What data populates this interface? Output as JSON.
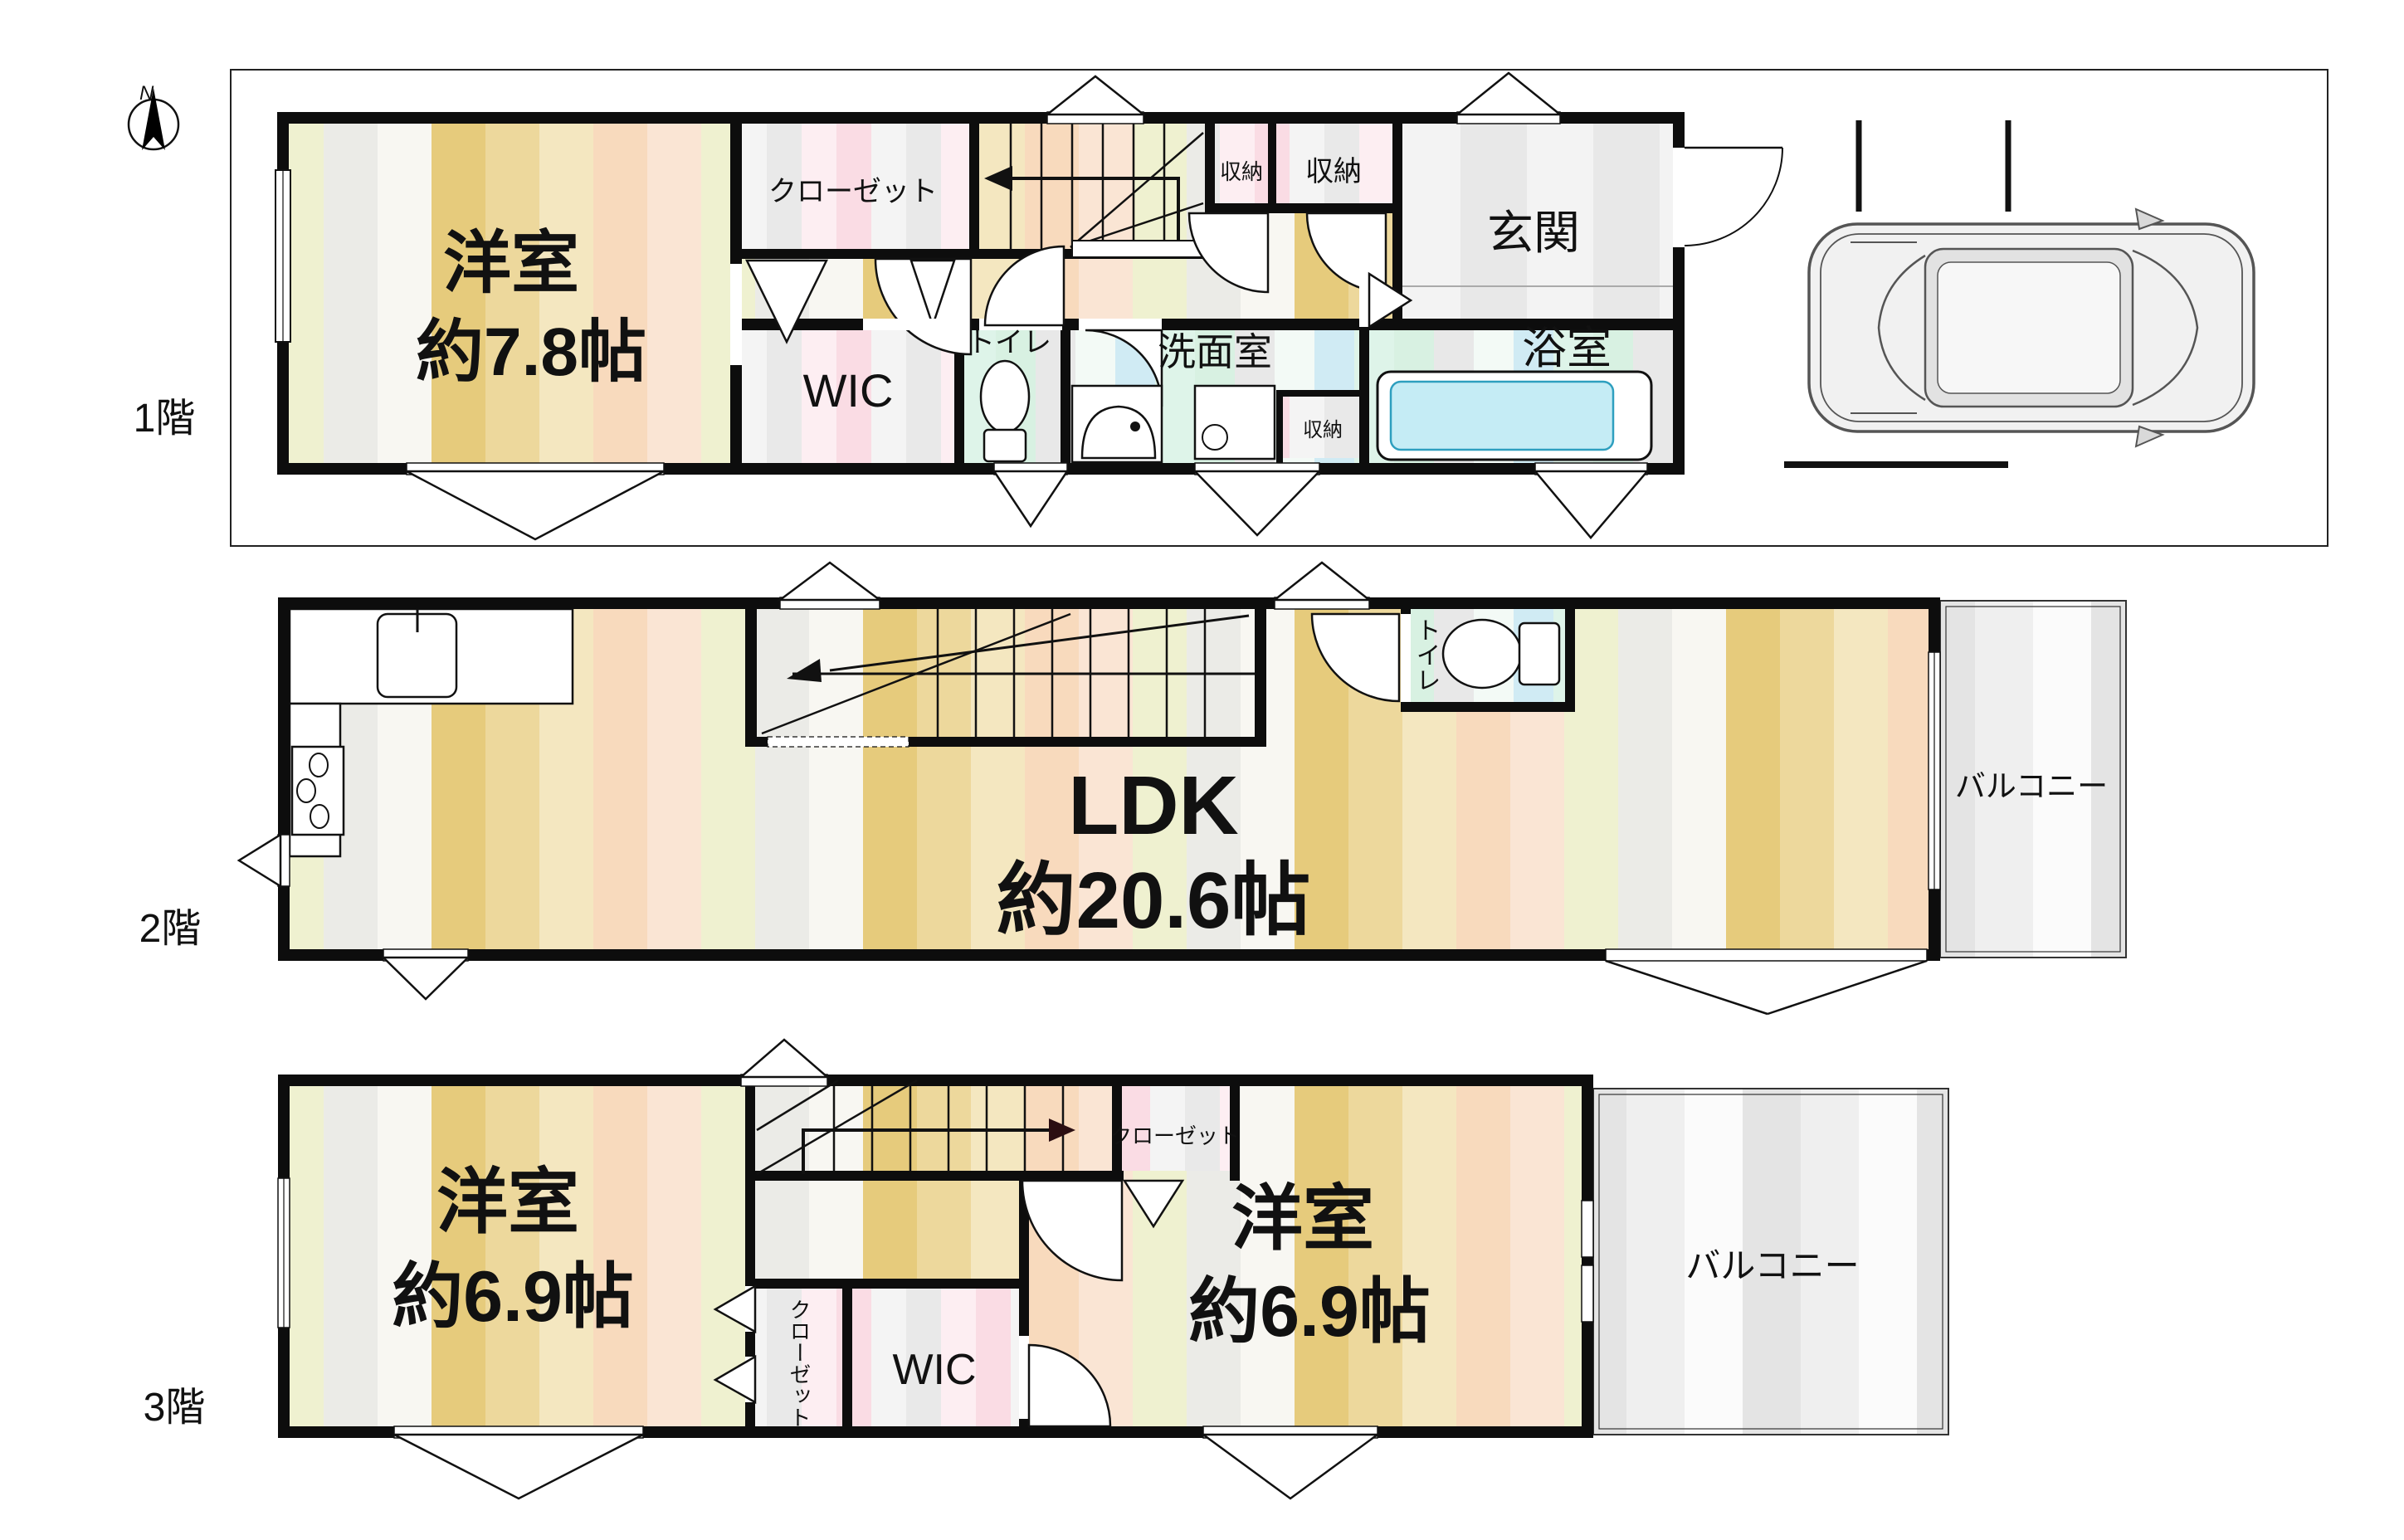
{
  "compass": {
    "north": "N"
  },
  "colors": {
    "wall": "#0d0d0d",
    "floor_gold": "#e6cb7c",
    "floor_tan": "#edd89c",
    "floor_cream": "#f4e7c0",
    "floor_peach": "#f8dabd",
    "floor_blush": "#fae5d4",
    "floor_green": "#eff1d0",
    "floor_gray": "#ebebe7",
    "wet_mint": "#d8f1e2",
    "wet_blue": "#d0ebf4",
    "closet_pink": "#fadce4",
    "balcony_gray": "#e4e4e4",
    "tub_water": "#c5ecf5"
  },
  "floor1": {
    "label": "1階",
    "rooms": {
      "western": {
        "label": "洋室",
        "size": "約7.8帖"
      },
      "closet": {
        "label": "クローゼット"
      },
      "storage_a": {
        "label": "収納"
      },
      "storage_b": {
        "label": "収納"
      },
      "entrance": {
        "label": "玄関"
      },
      "bathroom": {
        "label": "浴室"
      },
      "washroom": {
        "label": "洗面室"
      },
      "storage_c": {
        "label": "収納"
      },
      "toilet": {
        "label": "トイレ"
      },
      "wic": {
        "label": "WIC"
      }
    }
  },
  "floor2": {
    "label": "2階",
    "rooms": {
      "ldk": {
        "label": "LDK",
        "size": "約20.6帖"
      },
      "toilet": {
        "label": "トイレ"
      },
      "balcony": {
        "label": "バルコニー"
      }
    }
  },
  "floor3": {
    "label": "3階",
    "rooms": {
      "western_left": {
        "label": "洋室",
        "size": "約6.9帖"
      },
      "closet_upper": {
        "label": "クローゼット"
      },
      "western_right": {
        "label": "洋室",
        "size": "約6.9帖"
      },
      "closet_lower": {
        "label": "クローゼット"
      },
      "wic": {
        "label": "WIC"
      },
      "balcony": {
        "label": "バルコニー"
      }
    }
  }
}
